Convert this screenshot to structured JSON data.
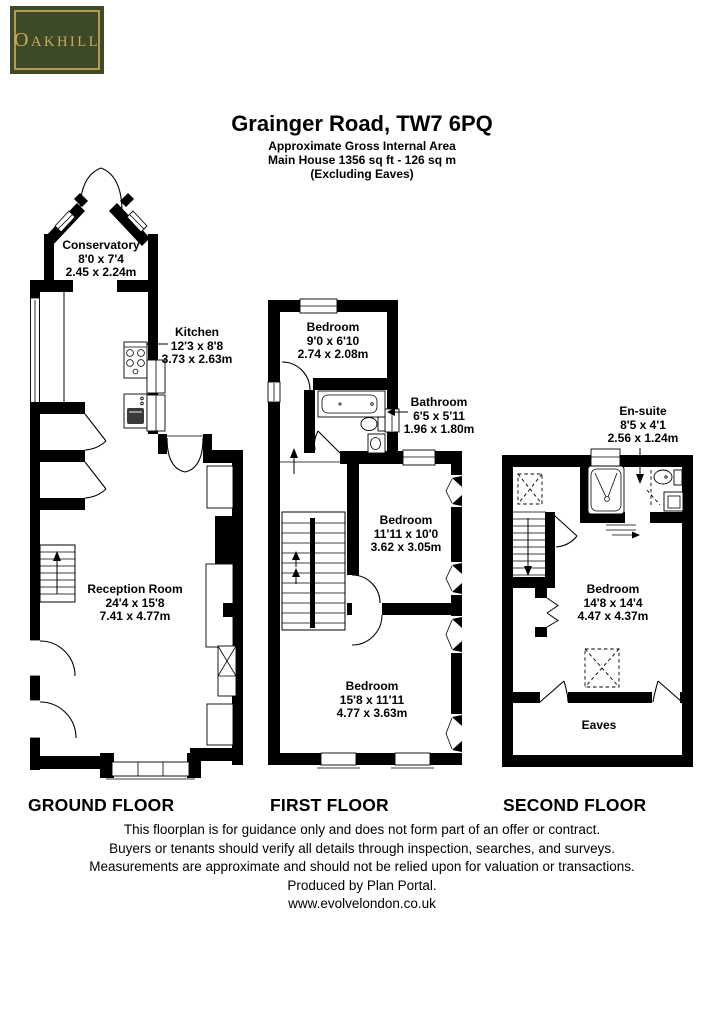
{
  "logo": {
    "initial": "O",
    "rest": "AKHILL"
  },
  "header": {
    "title": "Grainger Road, TW7 6PQ",
    "subtitle_lines": [
      "Approximate Gross Internal Area",
      "Main House 1356 sq ft - 126 sq m",
      "(Excluding Eaves)"
    ]
  },
  "floors": [
    {
      "label": "GROUND FLOOR",
      "rooms": [
        {
          "name": "Conservatory",
          "imperial": "8'0 x 7'4",
          "metric": "2.45 x 2.24m"
        },
        {
          "name": "Kitchen",
          "imperial": "12'3 x 8'8",
          "metric": "3.73 x 2.63m"
        },
        {
          "name": "Reception Room",
          "imperial": "24'4 x 15'8",
          "metric": "7.41 x 4.77m"
        }
      ]
    },
    {
      "label": "FIRST FLOOR",
      "rooms": [
        {
          "name": "Bedroom",
          "imperial": "9'0 x 6'10",
          "metric": "2.74 x 2.08m"
        },
        {
          "name": "Bathroom",
          "imperial": "6'5 x 5'11",
          "metric": "1.96 x 1.80m"
        },
        {
          "name": "Bedroom",
          "imperial": "11'11 x 10'0",
          "metric": "3.62 x 3.05m"
        },
        {
          "name": "Bedroom",
          "imperial": "15'8 x 11'11",
          "metric": "4.77 x 3.63m"
        }
      ]
    },
    {
      "label": "SECOND FLOOR",
      "rooms": [
        {
          "name": "En-suite",
          "imperial": "8'5 x 4'1",
          "metric": "2.56 x 1.24m"
        },
        {
          "name": "Bedroom",
          "imperial": "14'8 x 14'4",
          "metric": "4.47 x 4.37m"
        },
        {
          "name": "Eaves"
        }
      ]
    }
  ],
  "footer": {
    "lines": [
      "This floorplan is for guidance only and does not form part of an offer or contract.",
      "Buyers or tenants should verify all details through inspection, searches, and surveys.",
      "Measurements are approximate and should not be relied upon for valuation or transactions.",
      "Produced by Plan Portal.",
      "www.evolvelondon.co.uk"
    ]
  },
  "colors": {
    "logo_bg": "#3d4a27",
    "logo_border": "#b29a4e",
    "logo_text": "#c9ab58",
    "wall": "#000000"
  }
}
